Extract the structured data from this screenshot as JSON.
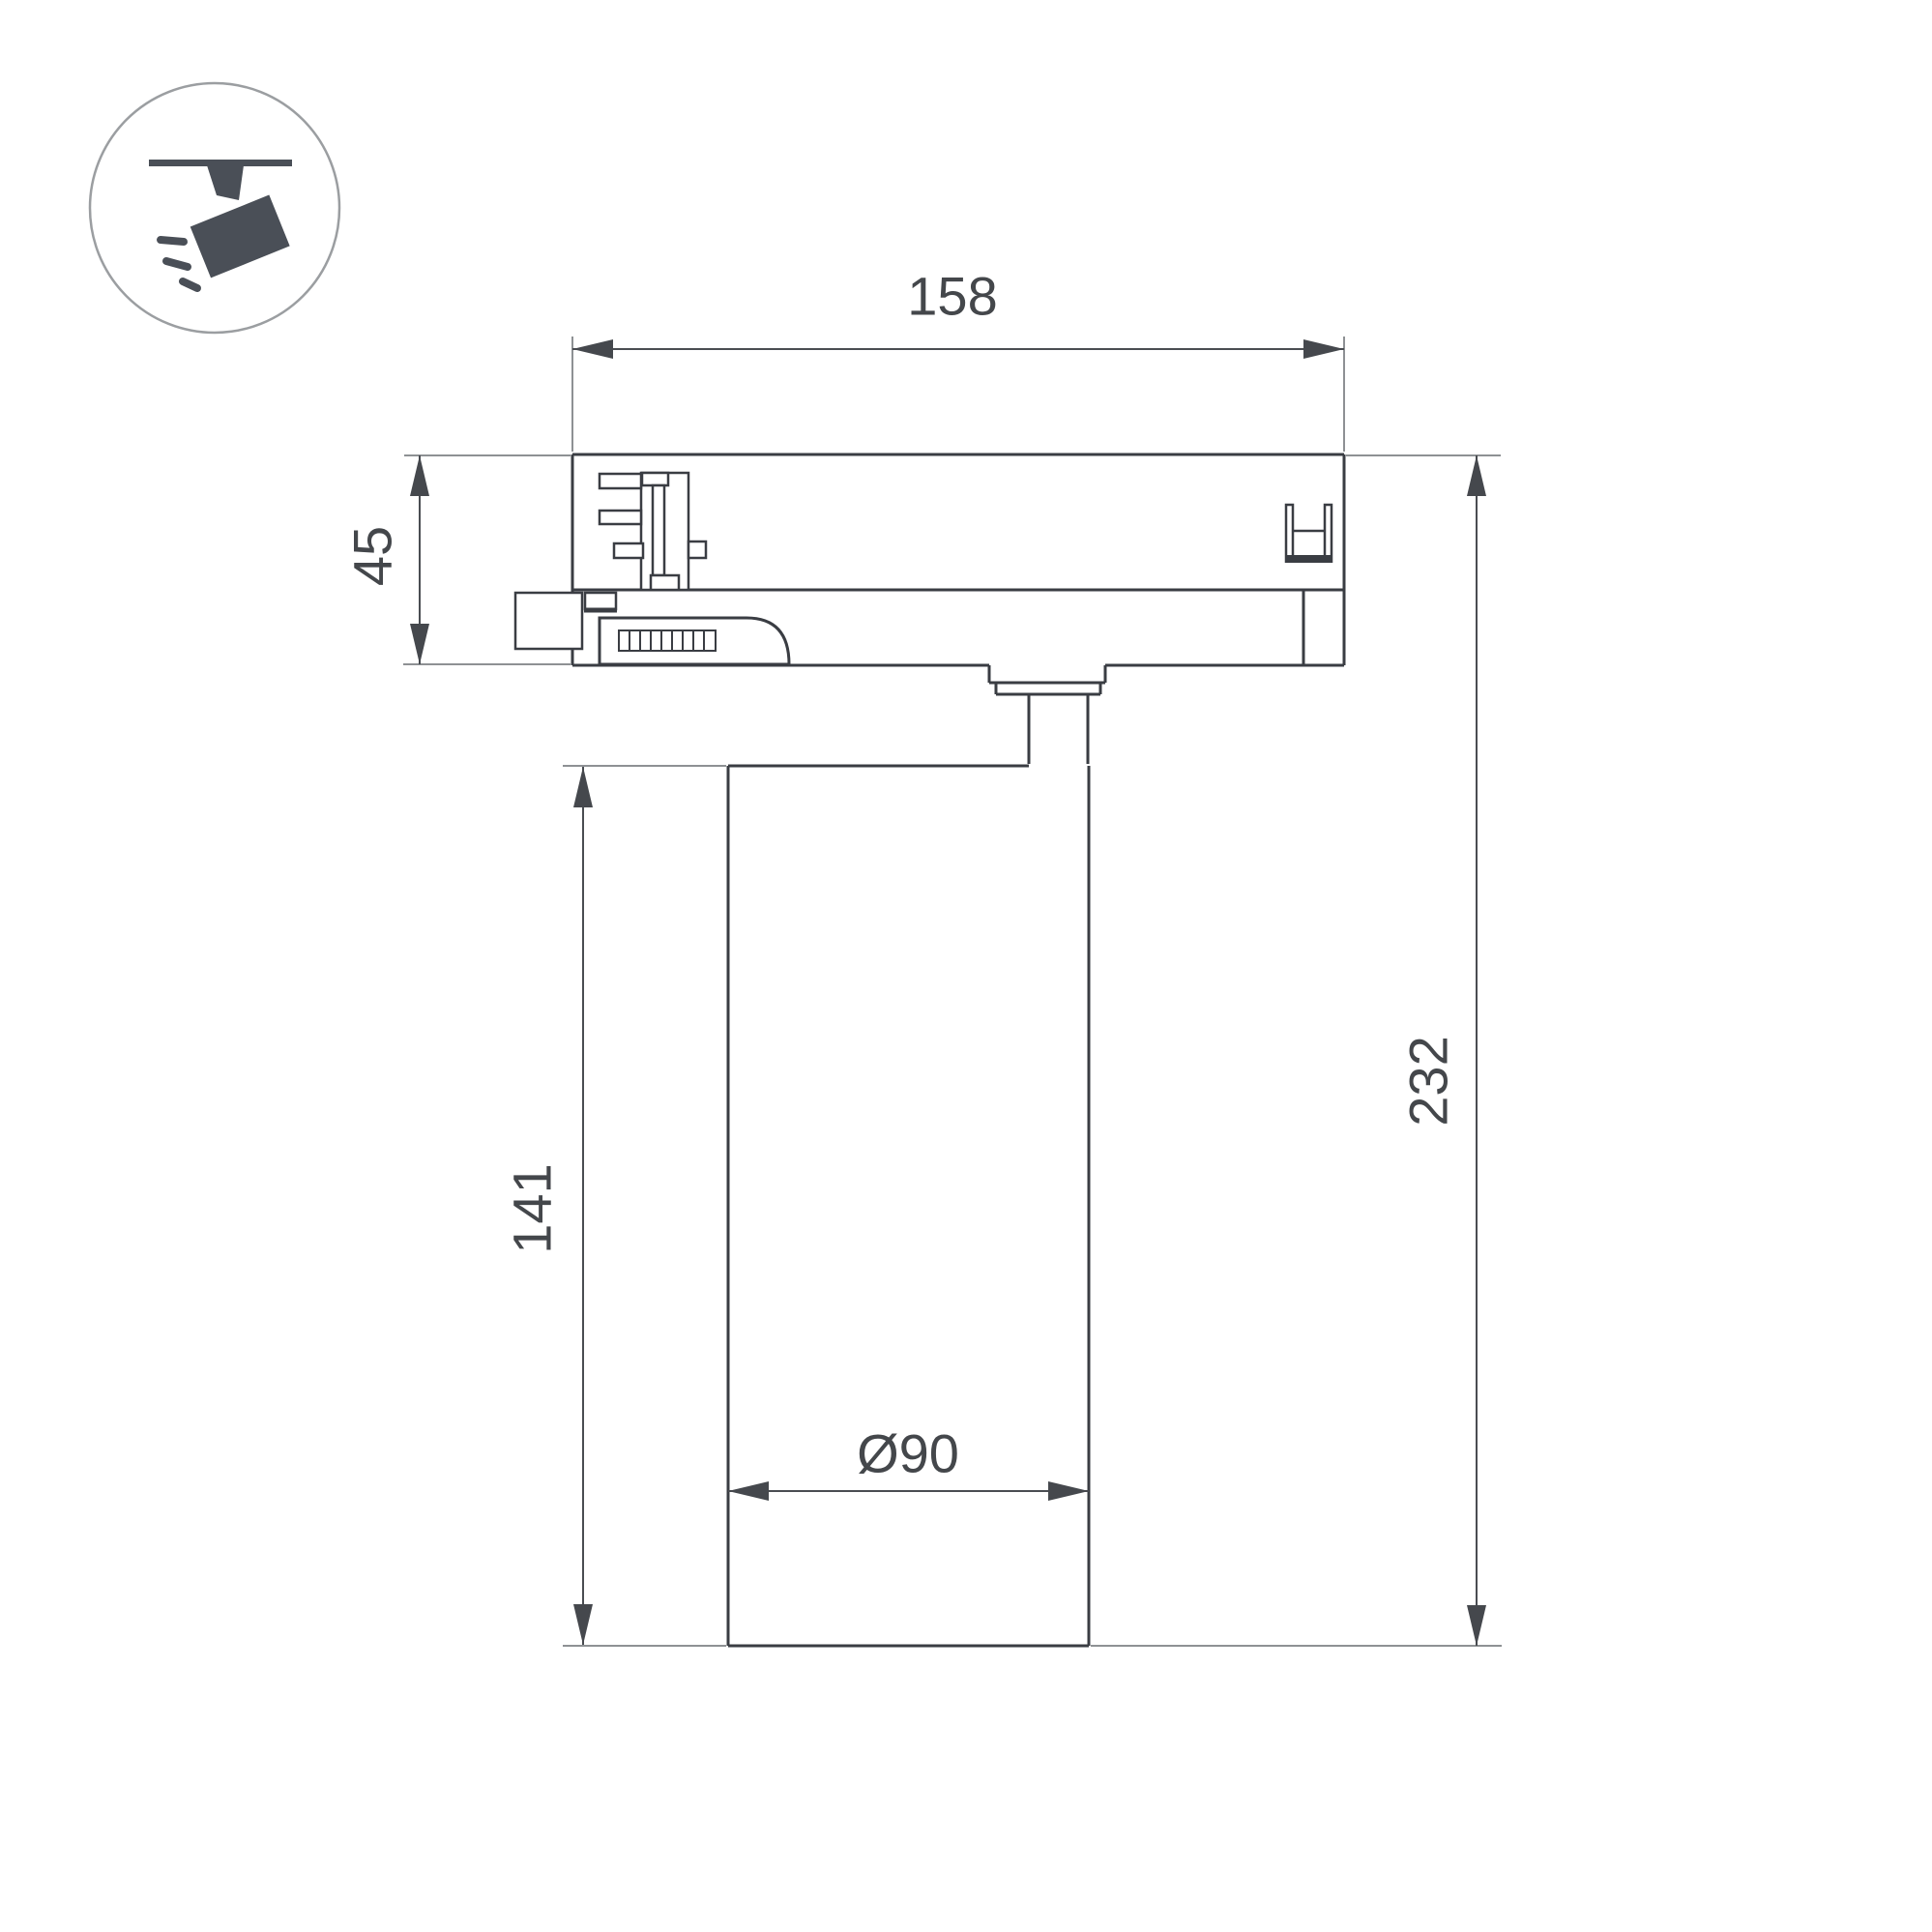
{
  "drawing": {
    "kind": "technical dimension drawing",
    "subject": "track-mounted spotlight, side section view"
  },
  "labels": {
    "top_width": "158",
    "adapter_height": "45",
    "body_height": "141",
    "total_height": "232",
    "diameter": "Ø90"
  },
  "icon": {
    "name": "track-spotlight",
    "description": "circular badge: ceiling track with tilted spotlight head emitting rays"
  },
  "colors": {
    "background": "#ffffff",
    "outline": "#3a3d43",
    "dimension_line": "#4a4d52",
    "extension_line": "#8e9194",
    "label_text": "#44474b",
    "icon_fill": "#4a4f57",
    "icon_circle_stroke": "#9b9ea1"
  }
}
